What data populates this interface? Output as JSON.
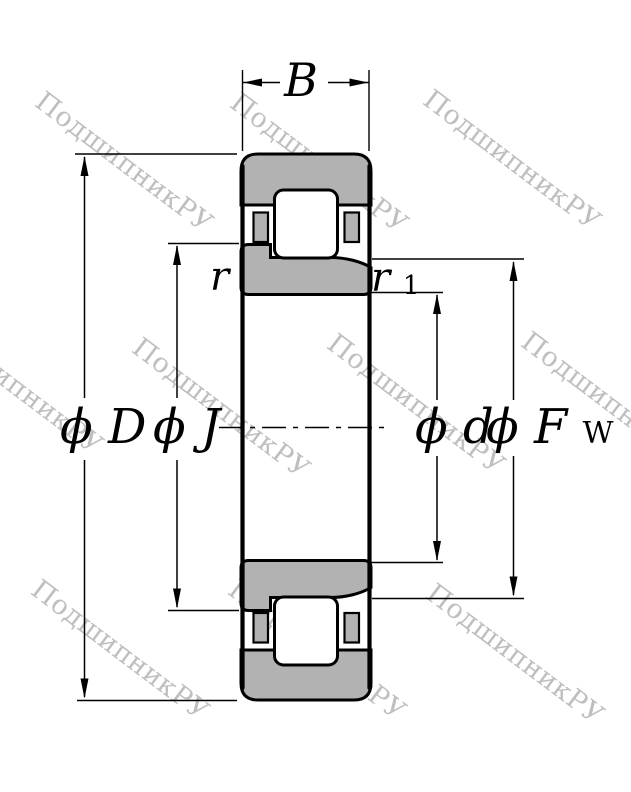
{
  "drawing": {
    "type": "cylindrical-roller-bearing-cross-section",
    "labels": {
      "width": "B",
      "diameter_symbol": "ϕ",
      "outer_diameter": "D",
      "flange_diameter": "J",
      "bore_diameter": "d",
      "raceway_diameter_letter": "F",
      "raceway_diameter_subscript": "W",
      "chamfer_outer": "r",
      "chamfer_inner_base": "r",
      "chamfer_inner_subscript": "1"
    },
    "colors": {
      "ring_fill": "#b2b2b2",
      "line": "#000000",
      "background": "#ffffff"
    }
  },
  "watermark": {
    "text": "ПодшипникРУ",
    "color": "#bfbfbf",
    "positions": [
      {
        "x": 48,
        "y": 86
      },
      {
        "x": 243,
        "y": 87
      },
      {
        "x": 436,
        "y": 84
      },
      {
        "x": -62,
        "y": 308
      },
      {
        "x": 145,
        "y": 332
      },
      {
        "x": 340,
        "y": 328
      },
      {
        "x": 534,
        "y": 326
      },
      {
        "x": 44,
        "y": 574
      },
      {
        "x": 241,
        "y": 574
      },
      {
        "x": 439,
        "y": 578
      }
    ]
  }
}
